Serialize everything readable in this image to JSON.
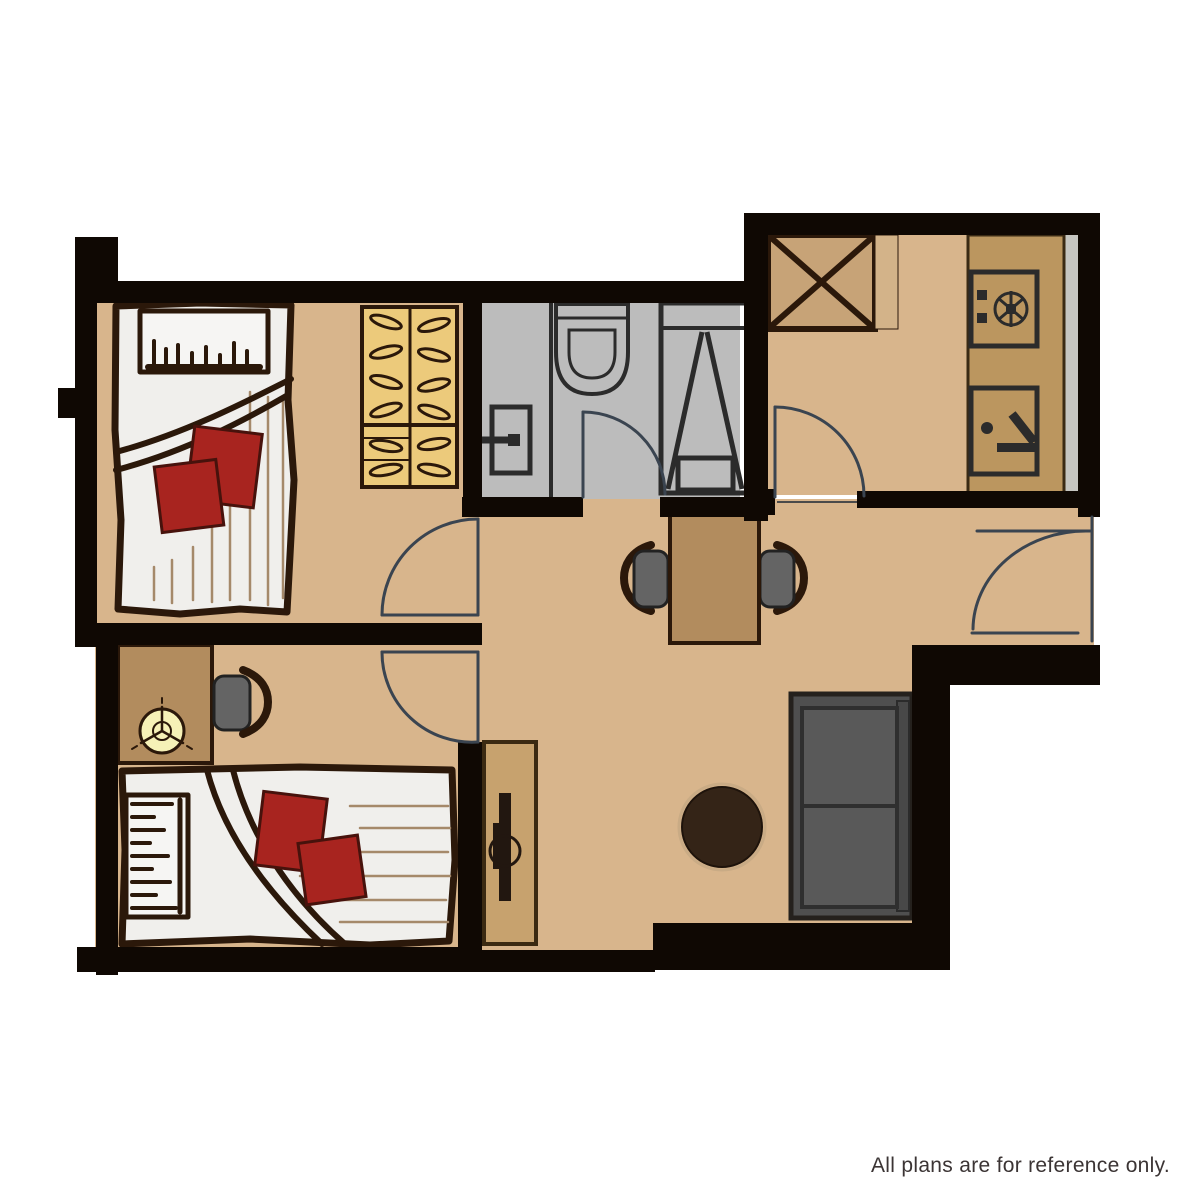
{
  "disclaimer": "All plans are for reference only.",
  "plan": {
    "type": "apartment-floor-plan",
    "elements": [
      "bedroom-1-single-bed",
      "wardrobe-with-hangers",
      "bathroom-washbasin",
      "bathroom-toilet",
      "bathroom-shower",
      "kitchen-appliance-box",
      "kitchen-stove",
      "kitchen-sink",
      "kitchen-counter",
      "dining-table",
      "dining-chair-left",
      "dining-chair-right",
      "entrance-door",
      "kitchen-door",
      "bathroom-door",
      "bedroom-1-door",
      "bedroom-2-door",
      "desk",
      "desk-chair",
      "table-fan",
      "bedroom-2-double-bed",
      "tv-cabinet",
      "coffee-table",
      "sofa"
    ]
  },
  "colors": {
    "bg": "#ffffff",
    "wall": "#0f0803",
    "floor": "#d8b58c",
    "bathroomFloor": "#bcbcbc",
    "wood": "#b28c5e",
    "counter": "#bb965f",
    "applianceTan": "#c7a377",
    "appliancePanel": "#d3b389",
    "wardrobe": "#ecca7b",
    "duvet": "#f0efec",
    "outline": "#2b180a",
    "pillowRed": "#a8241f",
    "chairGray": "#646464",
    "sofaGray": "#4f4f4f",
    "sofaCushion": "#595959",
    "coffeeDark": "#342417",
    "coffeeRim": "#c9ab85",
    "tvDark": "#221710",
    "fanYellow": "#f6f1b7",
    "doorLine": "#3a4450",
    "fixture": "#2b2b2b",
    "strip": "#c6c6c1",
    "stripe": "#a5896a",
    "text": "#3b3434"
  }
}
